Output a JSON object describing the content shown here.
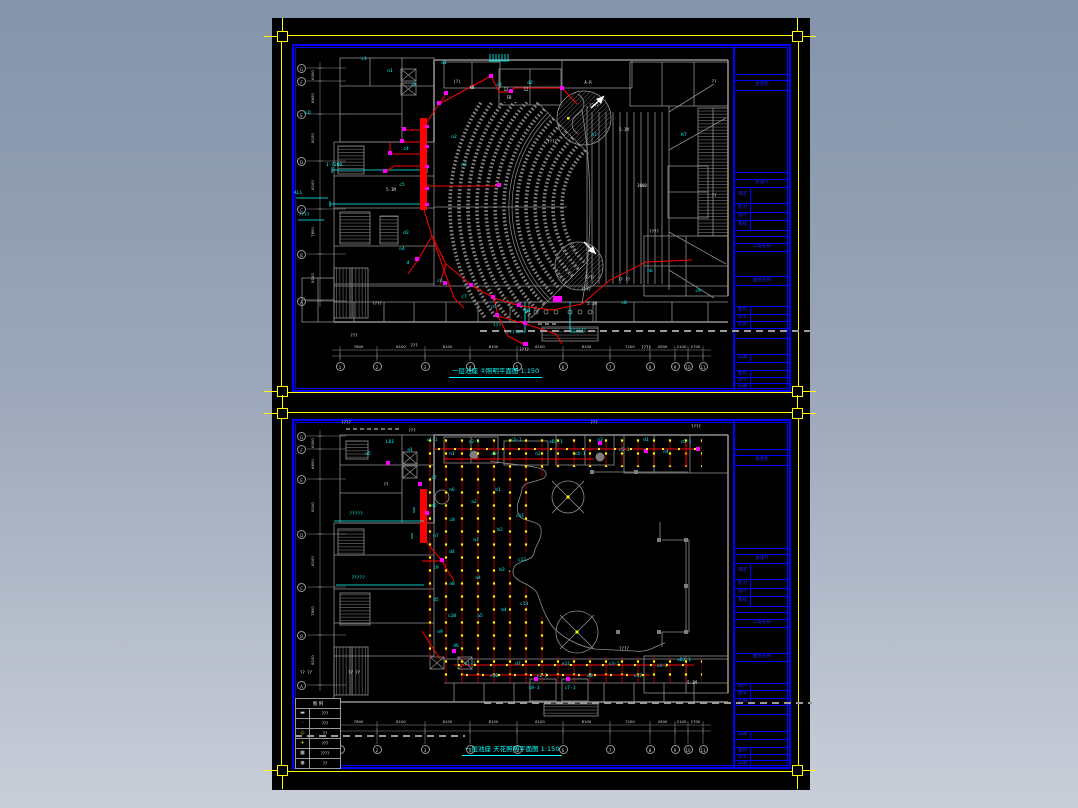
{
  "colors": {
    "frame_yellow": "#ffff00",
    "border_blue": "#0000ff",
    "wall_gray": "#8f8f8f",
    "wire_red": "#ff0000",
    "device_magenta": "#ff00ff",
    "label_cyan": "#00ffff",
    "light_yellow": "#ffff00",
    "text_white": "#ffffff",
    "canvas_black": "#000000",
    "bg_top": "#8494aa",
    "bg_bottom": "#c9ced9"
  },
  "title_block": {
    "rows": [
      {
        "h": 30,
        "label": ""
      },
      {
        "h": 6,
        "label": ""
      },
      {
        "h": 9,
        "label": "会签栏"
      },
      {
        "h": 88,
        "label": ""
      },
      {
        "h": 6,
        "label": ""
      },
      {
        "h": 8,
        "label": "总设计"
      },
      {
        "h": 16,
        "label": "审定",
        "cell": 1
      },
      {
        "h": 9,
        "label": "校对",
        "cell": 1
      },
      {
        "h": 7,
        "label": "设计",
        "cell": 1
      },
      {
        "h": 10,
        "label": "审核",
        "cell": 1
      },
      {
        "h": 6,
        "label": ""
      },
      {
        "h": 6,
        "label": ""
      },
      {
        "h": 8,
        "label": "工程名称"
      },
      {
        "h": 26,
        "label": ""
      },
      {
        "h": 8,
        "label": "图纸名称"
      },
      {
        "h": 22,
        "label": ""
      },
      {
        "h": 7,
        "label": "图别",
        "cell": 1
      },
      {
        "h": 7,
        "label": "图号",
        "cell": 1
      },
      {
        "h": 7,
        "label": "比例",
        "cell": 1
      },
      {
        "h": 9,
        "label": ""
      },
      {
        "h": 17,
        "label": ""
      },
      {
        "h": 7,
        "label": "日期",
        "cell": 1
      },
      {
        "h": 8,
        "label": ""
      },
      {
        "h": 6,
        "label": "图别",
        "cell": 1
      },
      {
        "h": 6,
        "label": "图号",
        "cell": 1
      },
      {
        "h": 6,
        "label": "日期",
        "cell": 1
      }
    ]
  },
  "sheet_top": {
    "caption": "一层池座 ②照明平面图 1:150",
    "grid_letters": [
      "G",
      "F",
      "E",
      "D",
      "C",
      "B",
      "A"
    ],
    "grid_numbers": [
      "1",
      "2",
      "3",
      "4",
      "5",
      "6",
      "7",
      "8",
      "9",
      "10",
      "11"
    ],
    "dims_h": [
      "7800",
      "8100",
      "8100",
      "8100",
      "8100",
      "8100",
      "7200",
      "4500",
      "2100",
      "2700"
    ],
    "dims_v": [
      "6000",
      "6600",
      "8100",
      "8100",
      "7800",
      "8100"
    ],
    "scatter_cyan": [
      [
        70,
        14,
        "c1"
      ],
      [
        96,
        26,
        "n1"
      ],
      [
        120,
        40,
        "c2"
      ],
      [
        150,
        18,
        "d1"
      ],
      [
        205,
        40,
        "c3"
      ],
      [
        236,
        38,
        "d2"
      ],
      [
        14,
        68,
        "LD"
      ],
      [
        40,
        120,
        "1-7200"
      ],
      [
        4,
        148,
        "AL1"
      ],
      [
        10,
        170,
        "????"
      ],
      [
        160,
        92,
        "n2"
      ],
      [
        170,
        120,
        "n3"
      ],
      [
        112,
        104,
        "c4"
      ],
      [
        108,
        140,
        "c5"
      ],
      [
        112,
        188,
        "d3"
      ],
      [
        108,
        204,
        "n4"
      ],
      [
        146,
        236,
        "c6"
      ],
      [
        114,
        218,
        "d"
      ],
      [
        170,
        252,
        "c7"
      ],
      [
        200,
        262,
        "n5"
      ],
      [
        234,
        266,
        "d4"
      ],
      [
        203,
        281,
        "???"
      ],
      [
        284,
        286,
        "??????"
      ],
      [
        218,
        288,
        "??????"
      ],
      [
        330,
        258,
        "c8"
      ],
      [
        356,
        226,
        "n6"
      ],
      [
        390,
        90,
        "KT"
      ],
      [
        300,
        90,
        "n7"
      ],
      [
        404,
        246,
        "c9"
      ]
    ],
    "scatter_white": [
      [
        163,
        36,
        "(?)"
      ],
      [
        178,
        42,
        "KB"
      ],
      [
        212,
        44,
        "12"
      ],
      [
        232,
        44,
        "12"
      ],
      [
        215,
        52,
        "FB"
      ],
      [
        294,
        37,
        "A-R"
      ],
      [
        258,
        96,
        "????"
      ],
      [
        300,
        60,
        "????"
      ],
      [
        330,
        84,
        "5.1M"
      ],
      [
        97,
        144,
        "5.1M"
      ],
      [
        348,
        140,
        "3000"
      ],
      [
        360,
        186,
        "????"
      ],
      [
        296,
        232,
        "????"
      ],
      [
        83,
        258,
        "????"
      ],
      [
        298,
        258,
        "5.1M"
      ],
      [
        330,
        234,
        "?? ??"
      ],
      [
        292,
        244,
        "????"
      ],
      [
        120,
        300,
        "???"
      ],
      [
        230,
        304,
        "????"
      ],
      [
        352,
        302,
        "????"
      ],
      [
        420,
        36,
        "??"
      ],
      [
        420,
        150,
        "??"
      ],
      [
        60,
        290,
        "???"
      ]
    ]
  },
  "sheet_bottom": {
    "caption": "一层池座 天花照明平面图 1:150",
    "grid_letters": [
      "G",
      "F",
      "E",
      "D",
      "C",
      "B",
      "A"
    ],
    "grid_numbers": [
      "1",
      "2",
      "3",
      "4",
      "5",
      "6",
      "7",
      "8",
      "9",
      "10",
      "11"
    ],
    "dims_h": [
      "7800",
      "8100",
      "8100",
      "8100",
      "8100",
      "8100",
      "7200",
      "4500",
      "2100",
      "2700"
    ],
    "dims_v": [
      "6000",
      "6600",
      "8100",
      "8100",
      "7800",
      "8100"
    ],
    "legend": {
      "header": "图 例",
      "rows": [
        {
          "sym": "bar",
          "text": "???"
        },
        {
          "sym": "tick",
          "text": "???"
        },
        {
          "sym": "diamond",
          "text": "??"
        },
        {
          "sym": "lamp",
          "text": "???"
        },
        {
          "sym": "square",
          "text": "????"
        },
        {
          "sym": "dot",
          "text": "??"
        }
      ]
    },
    "scatter_cyan": [
      [
        138,
        20,
        "c1-1"
      ],
      [
        158,
        34,
        "n1"
      ],
      [
        180,
        22,
        "c2-1"
      ],
      [
        200,
        34,
        "d3"
      ],
      [
        222,
        20,
        "c3-1"
      ],
      [
        244,
        34,
        "n2"
      ],
      [
        262,
        22,
        "xD1-1"
      ],
      [
        286,
        34,
        "c4-1"
      ],
      [
        306,
        20,
        "n3"
      ],
      [
        330,
        30,
        "c5-1"
      ],
      [
        352,
        20,
        "d1"
      ],
      [
        372,
        32,
        "n4"
      ],
      [
        392,
        22,
        "c6-1"
      ],
      [
        116,
        30,
        "a1"
      ],
      [
        96,
        22,
        "LD1"
      ],
      [
        74,
        34,
        "n5"
      ],
      [
        140,
        58,
        "c7"
      ],
      [
        158,
        70,
        "n6"
      ],
      [
        140,
        86,
        "d2"
      ],
      [
        158,
        100,
        "c8"
      ],
      [
        142,
        116,
        "n7"
      ],
      [
        158,
        132,
        "d4"
      ],
      [
        142,
        148,
        "c9"
      ],
      [
        158,
        164,
        "n8"
      ],
      [
        142,
        180,
        "d5"
      ],
      [
        158,
        196,
        "c10"
      ],
      [
        146,
        212,
        "n9"
      ],
      [
        162,
        226,
        "d6"
      ],
      [
        180,
        82,
        "a2"
      ],
      [
        182,
        120,
        "a3"
      ],
      [
        184,
        158,
        "a4"
      ],
      [
        186,
        196,
        "a5"
      ],
      [
        204,
        70,
        "b1"
      ],
      [
        206,
        110,
        "b2"
      ],
      [
        208,
        150,
        "b3"
      ],
      [
        210,
        190,
        "b4"
      ],
      [
        226,
        96,
        "c11"
      ],
      [
        228,
        140,
        "c12"
      ],
      [
        230,
        184,
        "c13"
      ],
      [
        176,
        244,
        "c1-2"
      ],
      [
        200,
        256,
        "n10"
      ],
      [
        224,
        244,
        "d7"
      ],
      [
        248,
        256,
        "c2-2"
      ],
      [
        272,
        244,
        "n11"
      ],
      [
        296,
        256,
        "d8"
      ],
      [
        320,
        244,
        "c3-2"
      ],
      [
        344,
        256,
        "n12"
      ],
      [
        368,
        246,
        "c4-2"
      ],
      [
        240,
        268,
        "c8-1"
      ],
      [
        276,
        268,
        "c7-1"
      ],
      [
        390,
        240,
        "xD2-1"
      ],
      [
        62,
        94,
        "?????"
      ],
      [
        64,
        158,
        "?????"
      ]
    ],
    "scatter_white": [
      [
        52,
        2,
        "????"
      ],
      [
        330,
        228,
        "????"
      ],
      [
        398,
        262,
        "5.1M"
      ],
      [
        92,
        64,
        "??"
      ],
      [
        12,
        252,
        "?? ??"
      ],
      [
        60,
        252,
        "?? ??"
      ],
      [
        300,
        2,
        "???"
      ],
      [
        402,
        6,
        "????"
      ],
      [
        118,
        10,
        "???"
      ]
    ]
  }
}
